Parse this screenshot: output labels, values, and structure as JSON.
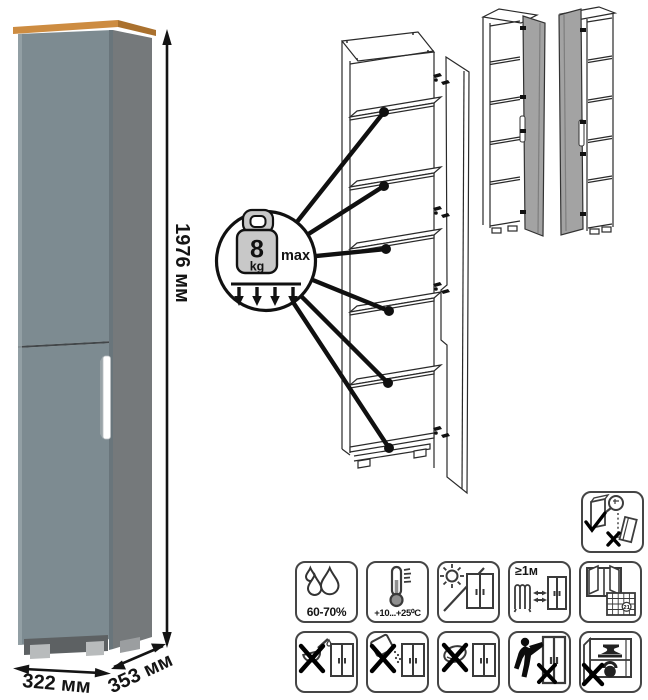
{
  "product": {
    "dimensions": {
      "height": "1976 мм",
      "width": "322 мм",
      "depth": "353 мм"
    },
    "colors": {
      "door": "#7d8b91",
      "door_highlight": "#9aa6ab",
      "side": "#75797b",
      "top_wood": "#cd8c41",
      "top_wood_side": "#aa712e",
      "handle": "#ffffff",
      "plinth": "#5d6163",
      "feet": "#b8bbbc",
      "gap": "#42474a",
      "diagram_door_fill": "#a3a3a3"
    }
  },
  "shelf_load": {
    "value": "8",
    "unit": "kg",
    "max_label": "max"
  },
  "icons": [
    {
      "name": "anchor-to-wall"
    },
    {
      "name": "humidity",
      "label": "60-70%"
    },
    {
      "name": "temperature",
      "label": "+10...+25⁰C"
    },
    {
      "name": "no-direct-sunlight"
    },
    {
      "name": "heat-distance",
      "label": "≥1м"
    },
    {
      "name": "ventilation",
      "calendar_day": "21"
    },
    {
      "name": "no-liquids"
    },
    {
      "name": "no-abrasive-powder"
    },
    {
      "name": "no-wet-cleaning"
    },
    {
      "name": "do-not-drag"
    },
    {
      "name": "do-not-overload"
    }
  ]
}
